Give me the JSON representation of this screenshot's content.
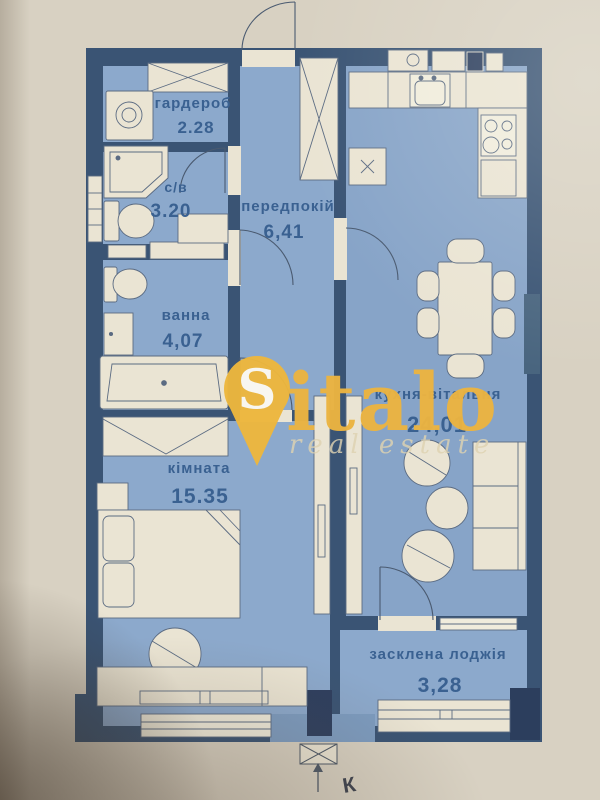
{
  "photo": {
    "paper_color": "#d8d1c2"
  },
  "plan": {
    "wall_color": "#3a5474",
    "floor_color": "#8ca9cc",
    "fixture_color": "#eae4d3",
    "label_color": "#3a6191",
    "rooms": [
      {
        "id": "wardrobe",
        "name": "гардероб",
        "area": "2.28"
      },
      {
        "id": "wc",
        "name": "с/в",
        "area": "3.20"
      },
      {
        "id": "hallway",
        "name": "передпокій",
        "area": "6,41"
      },
      {
        "id": "bathroom",
        "name": "ванна",
        "area": "4,07"
      },
      {
        "id": "kitchen_living",
        "name": "кухня-вітальня",
        "area": "24,01"
      },
      {
        "id": "bedroom",
        "name": "кімната",
        "area": "15.35"
      },
      {
        "id": "loggia",
        "name": "засклена лоджія",
        "area": "3,28"
      }
    ],
    "compass_label": "К"
  },
  "watermark": {
    "initial": "S",
    "brand": "italo",
    "tagline": "real estate",
    "pin_color": "#eeb73d",
    "text_color": "#ecb440"
  }
}
